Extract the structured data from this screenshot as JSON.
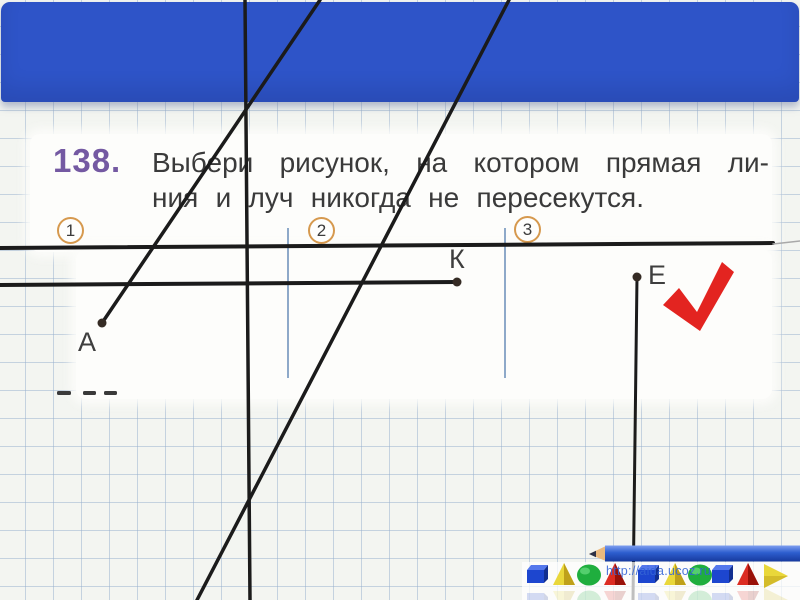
{
  "slide": {
    "task": {
      "number": "138.",
      "line1": "Выбери рисунок, на котором прямая ли-",
      "line2": "ния и луч никогда не пересекутся."
    },
    "figures": [
      {
        "number": "1",
        "point": "А",
        "checked": false
      },
      {
        "number": "2",
        "point": "К",
        "checked": false
      },
      {
        "number": "3",
        "point": "Е",
        "checked": true
      }
    ],
    "watermark": "http://aida.ucoz.ru"
  },
  "colors": {
    "band-blue": "#2e54c8",
    "paper": "#f3f5f1",
    "grid-line": "rgba(150,175,205,0.5)",
    "scan-white": "#fdfdfb",
    "text-dark": "#3a3a3a",
    "number-purple": "#7459a2",
    "circle-orange": "#d6994e",
    "line-black": "#1b1b1b",
    "separator-blue": "#8ea9c9",
    "check-red": "#e32420",
    "url-blue": "#3565d6",
    "pencil-blue": "#2d5ecf",
    "pencil-wood": "#eab97e"
  },
  "geometry": {
    "lines": [
      {
        "name": "straight-line-vertical",
        "x1": 245,
        "y1": 0,
        "x2": 250,
        "y2": 600,
        "w": 3.5
      },
      {
        "name": "straight-line-diagonal",
        "x1": 509,
        "y1": 0,
        "x2": 197,
        "y2": 600,
        "w": 3.5
      },
      {
        "name": "ray-from-point-a",
        "x1": 102,
        "y1": 323,
        "x2": 320,
        "y2": 0,
        "w": 3.5
      },
      {
        "name": "straight-line-horizontal",
        "x1": 0,
        "y1": 248,
        "x2": 773,
        "y2": 243,
        "w": 4
      },
      {
        "name": "straight-line-horizontal-faint",
        "x1": 773,
        "y1": 244,
        "x2": 800,
        "y2": 241,
        "w": 1.5,
        "color": "#a9a9a9"
      },
      {
        "name": "ray-from-point-k",
        "x1": 457,
        "y1": 282,
        "x2": 0,
        "y2": 285,
        "w": 4
      },
      {
        "name": "ray-from-point-e",
        "x1": 637,
        "y1": 277,
        "x2": 633,
        "y2": 600,
        "w": 3
      }
    ],
    "separators": [
      {
        "name": "figure-separator-1",
        "x": 288,
        "y1": 228,
        "y2": 378
      },
      {
        "name": "figure-separator-2",
        "x": 505,
        "y1": 228,
        "y2": 378
      }
    ],
    "points": [
      {
        "name": "point-a",
        "x": 102,
        "y": 323
      },
      {
        "name": "point-k",
        "x": 457,
        "y": 282
      },
      {
        "name": "point-e",
        "x": 637,
        "y": 277
      }
    ],
    "check": "M663,305 L679,288 L697,312 L722,262 L734,272 L700,331 Z",
    "dashes": [
      {
        "x": 57,
        "y": 391,
        "w": 14
      },
      {
        "x": 83,
        "y": 391,
        "w": 13
      },
      {
        "x": 104,
        "y": 391,
        "w": 13
      }
    ]
  },
  "toolbar": {
    "shapes": [
      {
        "type": "cube",
        "color": "blue",
        "x": 527
      },
      {
        "type": "pyramid",
        "color": "yellow",
        "x": 553
      },
      {
        "type": "sphere",
        "color": "green",
        "x": 578
      },
      {
        "type": "pyramid",
        "color": "red",
        "x": 604
      },
      {
        "type": "cube",
        "color": "blue",
        "x": 638
      },
      {
        "type": "pyramid",
        "color": "yellow",
        "x": 664
      },
      {
        "type": "sphere",
        "color": "green",
        "x": 689
      },
      {
        "type": "cube",
        "color": "blue",
        "x": 712
      },
      {
        "type": "pyramid",
        "color": "red",
        "x": 737
      },
      {
        "type": "cone",
        "color": "yellow",
        "x": 764
      }
    ],
    "palette": {
      "blue": {
        "a": "#1d46cf",
        "b": "#5578ec",
        "c": "#122f90"
      },
      "yellow": {
        "a": "#e9d73a",
        "b": "#f2e88a",
        "c": "#bfa11a"
      },
      "green": {
        "a": "#1fae3e",
        "b": "#66d97e",
        "c": "#148030"
      },
      "red": {
        "a": "#dc2c22",
        "b": "#ef6a5e",
        "c": "#991109"
      }
    }
  }
}
